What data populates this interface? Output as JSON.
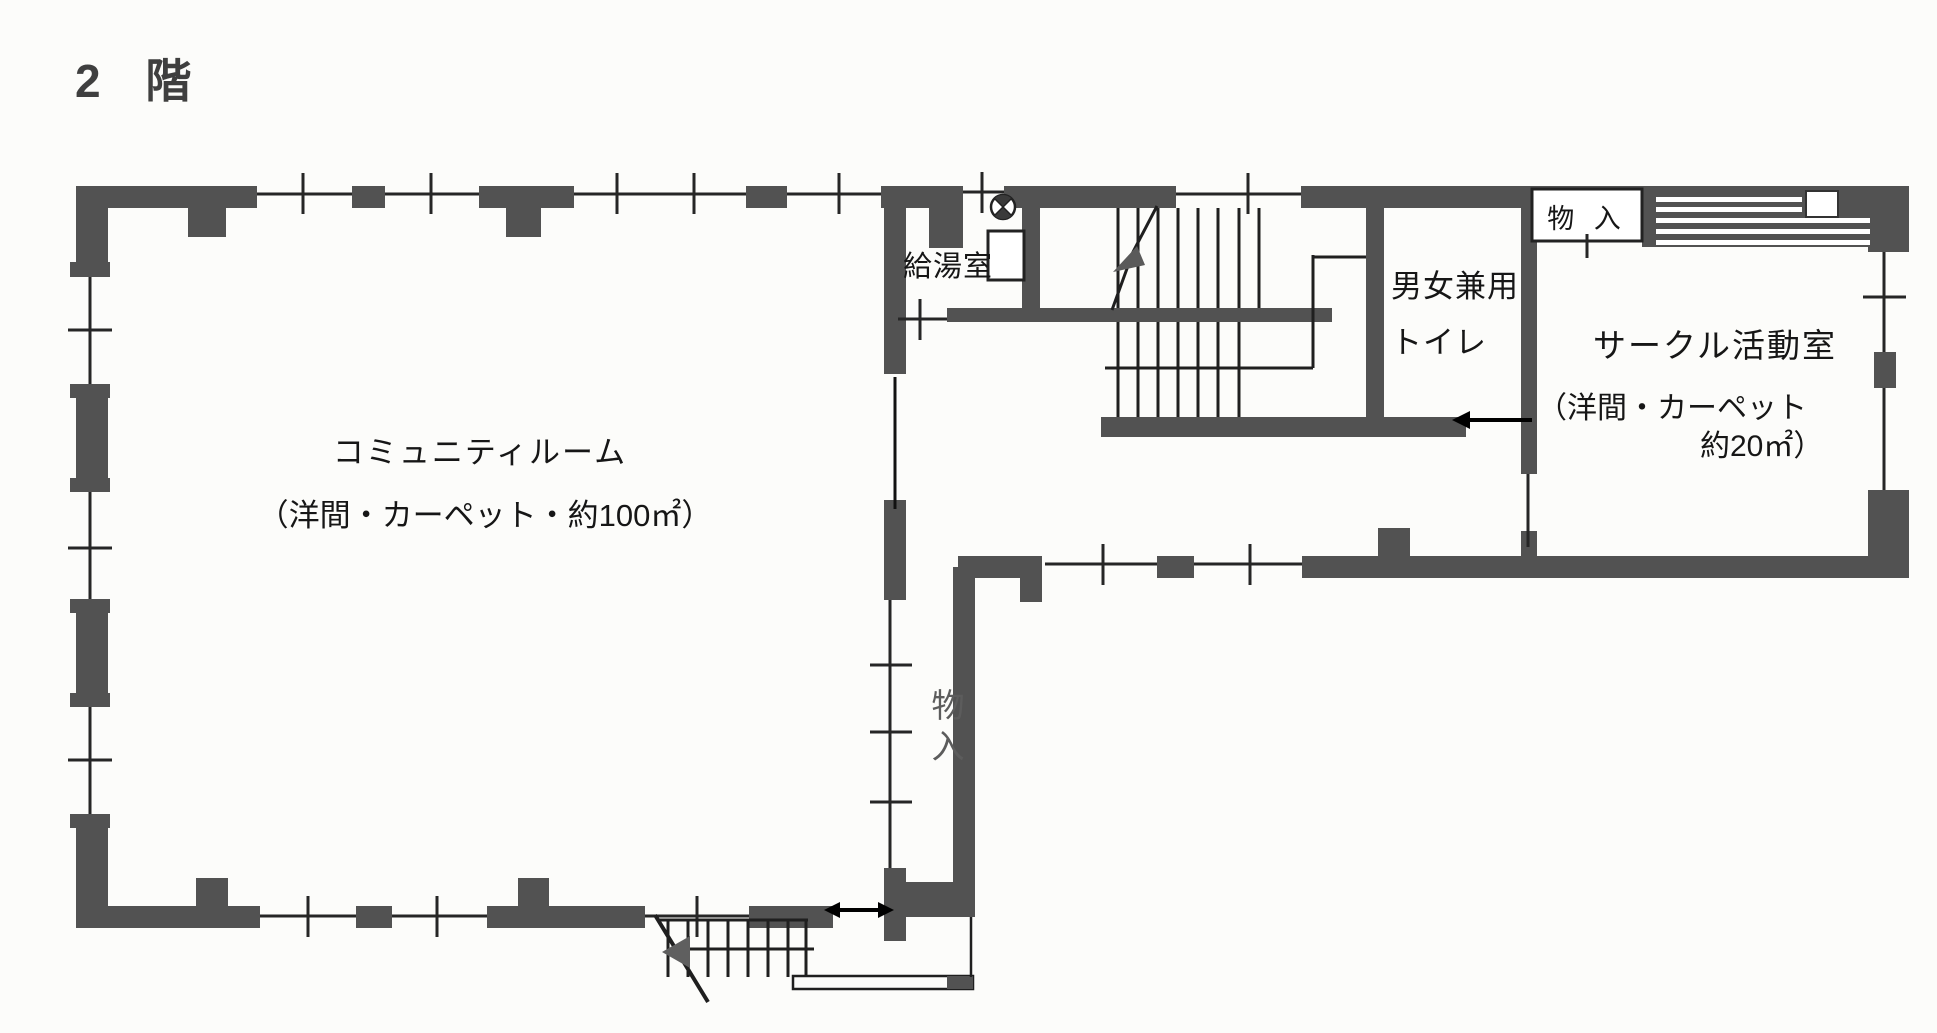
{
  "title": "2 階",
  "colors": {
    "wall": "#525252",
    "thin_line": "#262626",
    "black_arrow": "#000000",
    "grey_arrow": "#5f5f5f",
    "background": "#fcfcfa",
    "muted_label": "#5c5c5c"
  },
  "rooms": {
    "community_room": {
      "name": "コミュニティルーム",
      "spec": "（洋間・カーペット・約100㎡）"
    },
    "kitchenette": {
      "name": "給湯室"
    },
    "toilet": {
      "line1": "男女兼用",
      "line2": "トイレ"
    },
    "circle_activity_room": {
      "name": "サークル活動室",
      "spec_line1": "（洋間・カーペット",
      "spec_line2": "約20㎡）"
    },
    "storage_closet_top": {
      "name": "物 入"
    },
    "storage_closet_mid": {
      "name": "物入"
    }
  },
  "icons": {
    "circle_cross": "circle-cross-marker",
    "stair_direction": "stair-direction-arrow",
    "exterior_stair_direction": "stair-direction-arrow",
    "entrance_span": "double-headed-arrow",
    "room_entry": "left-arrow"
  }
}
